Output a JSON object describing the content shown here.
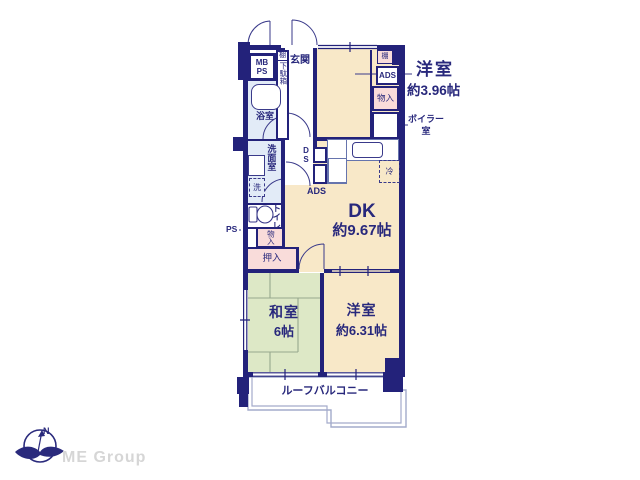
{
  "colors": {
    "wall": "#23227a",
    "text": "#28287c",
    "room_cream": "#f8e8c8",
    "room_green": "#dde8c6",
    "room_pink": "#f9dcda",
    "room_blue": "#e2ebf7",
    "fixture_line": "#6674ad",
    "balcony_line": "#a3abcb",
    "logo_gray": "#d6d6d6"
  },
  "plan": {
    "rooms": {
      "yoshitsu_a": {
        "label": "洋室",
        "size": "約3.96帖"
      },
      "dk": {
        "label": "DK",
        "size": "約9.67帖"
      },
      "washitsu": {
        "label": "和室",
        "size": "6帖"
      },
      "yoshitsu_b": {
        "label": "洋室",
        "size": "約6.31帖"
      },
      "genkan": {
        "label": "玄関"
      },
      "bath": {
        "label": "浴室"
      },
      "washroom": {
        "label": "洗面室"
      },
      "toilet": {
        "label": "トイレ"
      },
      "balcony": {
        "label": "ルーフバルコニー"
      }
    },
    "fixtures": {
      "mbps": "MB\nPS",
      "tana_shoe": "棚",
      "getabako": "下駄箱",
      "tana_right": "棚",
      "ads_top": "ADS",
      "monoire_right": "物入",
      "boiler": "ボイラー\n室",
      "ds": "D\nS",
      "ads_mid": "ADS",
      "fridge": "冷",
      "washer": "洗",
      "ps": "PS",
      "monoire_mid": "物入",
      "oshiire": "押入"
    }
  },
  "logo": {
    "company": "ME Group",
    "compass_n": "N"
  }
}
